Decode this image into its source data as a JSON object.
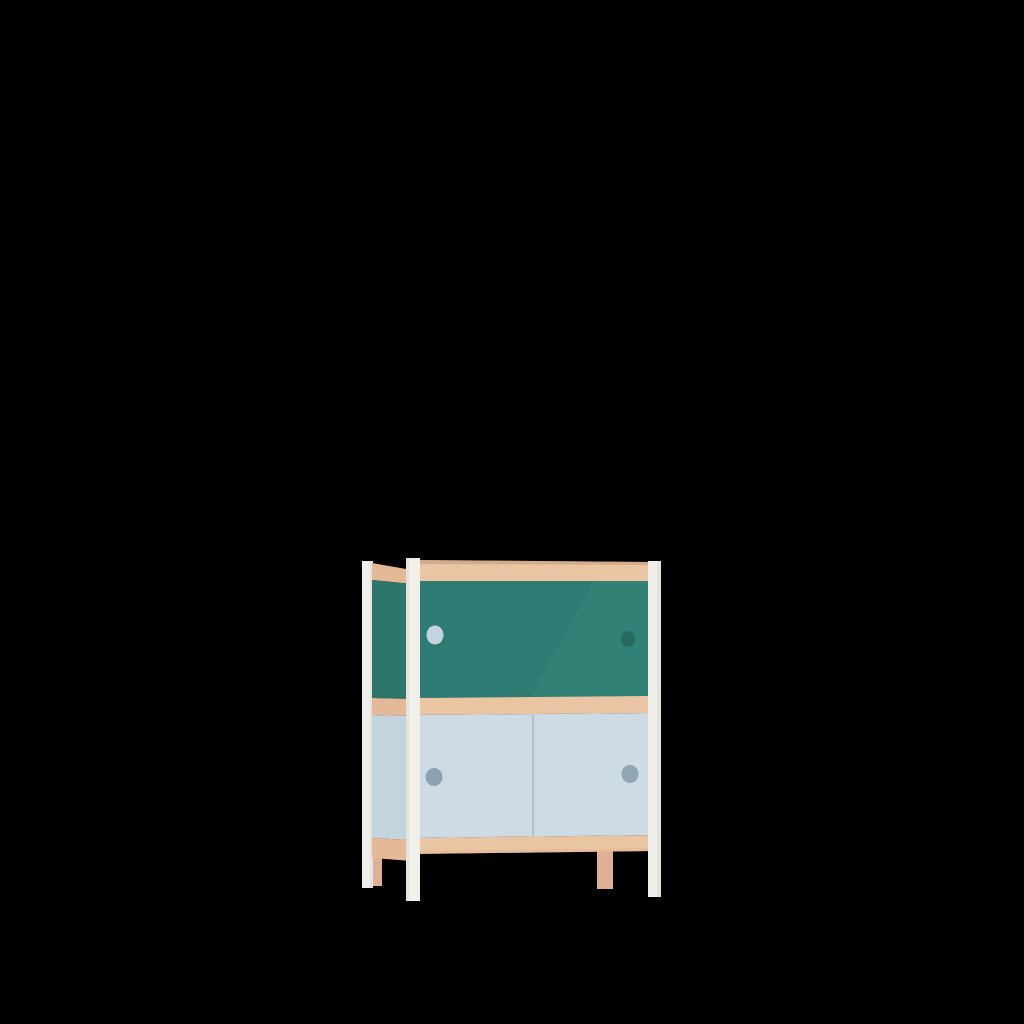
{
  "scene": {
    "type": "3d-product-render",
    "description": "Two-tier children's cabinet with sliding doors (teal upper doors, light-blue lower doors), plywood rails and white legs, centered on a solid black background",
    "background_color": "#000000"
  },
  "cabinet": {
    "colors": {
      "wood_front": "#eac5a4",
      "wood_front_dark": "#e3b696",
      "wood_side": "#e4b998",
      "wood_edge_dark": "#c99e7e",
      "teal_door": "#2d7b72",
      "teal_door_highlight": "#37897c",
      "teal_side": "#2d746b",
      "blue_door": "#cddbe4",
      "blue_side": "#c4d4df",
      "blue_seam": "#a9bcc8",
      "leg_white": "#f1efe9",
      "leg_white_shade": "#dcd9d2",
      "leg_wood": "#dfb093",
      "handle_upper_left": "#c4d4dc",
      "handle_upper_right": "#276a60",
      "handle_lower_left": "#8da2b0",
      "handle_lower_right": "#91a6b3"
    },
    "parts": {
      "upper_section": {
        "door_count": 2,
        "door_color_name": "teal",
        "handle_style": "round finger hole"
      },
      "lower_section": {
        "door_count": 2,
        "door_color_name": "light blue",
        "handle_style": "round finger hole",
        "visible_door_seam": true
      },
      "rails": {
        "material": "plywood",
        "count_visible": 3
      },
      "legs": {
        "count": 4,
        "white_legs": 3,
        "wood_legs": 1
      }
    }
  }
}
